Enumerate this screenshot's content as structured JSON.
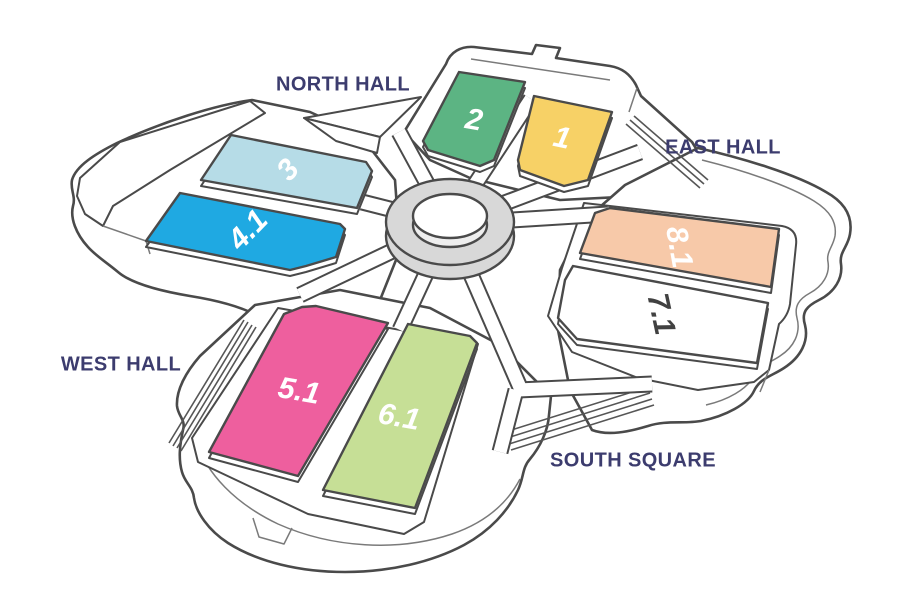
{
  "map": {
    "background": "#ffffff",
    "outline_color": "#4a4a4a",
    "detail_color": "#7a7a7a",
    "track_color": "#565656",
    "hub_fill": "#d8d8d8",
    "label_color": "#3c3c6e",
    "area_labels": [
      {
        "id": "north-hall",
        "text": "NORTH HALL",
        "x": 343,
        "y": 85
      },
      {
        "id": "east-hall",
        "text": "EAST HALL",
        "x": 723,
        "y": 148
      },
      {
        "id": "west-hall",
        "text": "WEST HALL",
        "x": 121,
        "y": 365
      },
      {
        "id": "south-square",
        "text": "SOUTH SQUARE",
        "x": 633,
        "y": 461
      }
    ],
    "halls": [
      {
        "id": "2",
        "label": "2",
        "fill": "#5cb483",
        "label_color": "#ffffff",
        "label_x": 474,
        "label_y": 120,
        "label_rotate": 10,
        "points": [
          [
            459,
            72
          ],
          [
            525,
            82
          ],
          [
            494,
            160
          ],
          [
            480,
            166
          ],
          [
            428,
            150
          ],
          [
            423,
            141
          ]
        ]
      },
      {
        "id": "1",
        "label": "1",
        "fill": "#f7d166",
        "label_color": "#ffffff",
        "label_x": 562,
        "label_y": 138,
        "label_rotate": 12,
        "points": [
          [
            534,
            96
          ],
          [
            612,
            112
          ],
          [
            588,
            180
          ],
          [
            564,
            186
          ],
          [
            520,
            170
          ],
          [
            518,
            160
          ]
        ]
      },
      {
        "id": "3",
        "label": "3",
        "fill": "#b6dce7",
        "label_color": "#ffffff",
        "label_x": 288,
        "label_y": 170,
        "label_rotate": -48,
        "points": [
          [
            231,
            135
          ],
          [
            366,
            162
          ],
          [
            372,
            171
          ],
          [
            357,
            208
          ],
          [
            201,
            180
          ]
        ]
      },
      {
        "id": "4.1",
        "label": "4.1",
        "fill": "#1fa9e2",
        "label_color": "#ffffff",
        "label_x": 248,
        "label_y": 230,
        "label_rotate": -46,
        "points": [
          [
            180,
            193
          ],
          [
            340,
            224
          ],
          [
            345,
            229
          ],
          [
            336,
            257
          ],
          [
            306,
            266
          ],
          [
            290,
            270
          ],
          [
            146,
            241
          ]
        ]
      },
      {
        "id": "5.1",
        "label": "5.1",
        "fill": "#ee5f9e",
        "label_color": "#ffffff",
        "label_x": 299,
        "label_y": 391,
        "label_rotate": 10,
        "points": [
          [
            284,
            314
          ],
          [
            302,
            307
          ],
          [
            316,
            306
          ],
          [
            388,
            323
          ],
          [
            298,
            476
          ],
          [
            209,
            452
          ]
        ]
      },
      {
        "id": "6.1",
        "label": "6.1",
        "fill": "#c6df96",
        "label_color": "#ffffff",
        "label_x": 399,
        "label_y": 417,
        "label_rotate": 10,
        "points": [
          [
            408,
            324
          ],
          [
            470,
            336
          ],
          [
            477,
            343
          ],
          [
            415,
            508
          ],
          [
            323,
            490
          ]
        ]
      },
      {
        "id": "8.1",
        "label": "8.1",
        "fill": "#f7c9a9",
        "label_color": "#ffffff",
        "label_x": 679,
        "label_y": 247,
        "label_rotate": 80,
        "points": [
          [
            610,
            208
          ],
          [
            779,
            229
          ],
          [
            771,
            287
          ],
          [
            580,
            253
          ],
          [
            595,
            213
          ]
        ]
      },
      {
        "id": "7.1",
        "label": "7.1",
        "fill": "#ffffff",
        "label_color": "#414141",
        "label_x": 661,
        "label_y": 314,
        "label_rotate": 78,
        "points": [
          [
            573,
            266
          ],
          [
            768,
            303
          ],
          [
            757,
            363
          ],
          [
            577,
            339
          ],
          [
            558,
            318
          ],
          [
            565,
            280
          ]
        ]
      }
    ]
  }
}
